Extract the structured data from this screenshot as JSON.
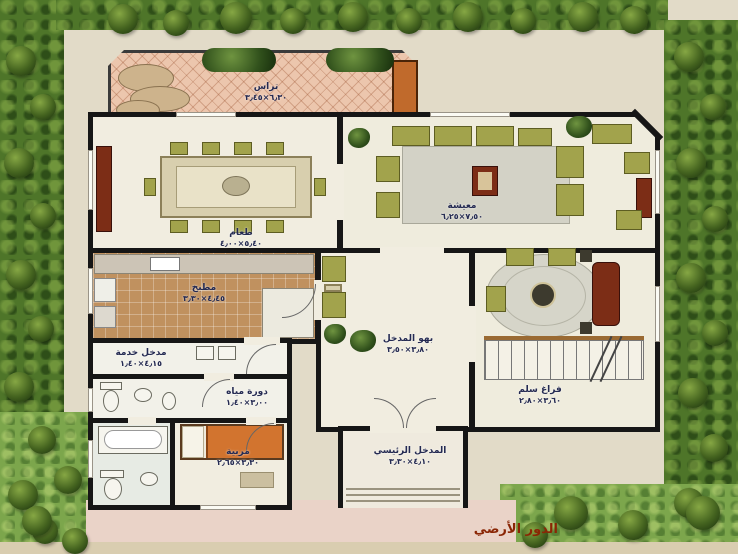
{
  "caption": "الدور الأرضي",
  "rooms": {
    "terrace": {
      "name": "تراس",
      "dims": "٦٫٣٠×٣٫٤٥"
    },
    "dining": {
      "name": "طعام",
      "dims": "٥٫٤٠×٤٫٠٠"
    },
    "living": {
      "name": "معيشة",
      "dims": "٧٫٥٠×٦٫٢٥"
    },
    "kitchen": {
      "name": "مطبخ",
      "dims": "٤٫٤٥×٣٫٣٠"
    },
    "hall": {
      "name": "بهو المدخل",
      "dims": "٣٫٨٠×٣٫٥٠"
    },
    "stairs": {
      "name": "فراغ سلم",
      "dims": "٣٫٦٠×٢٫٨٠"
    },
    "entrance": {
      "name": "المدخل الرئيسي",
      "dims": "٤٫١٠×٣٫٣٠"
    },
    "service": {
      "name": "مدخل خدمة",
      "dims": "٤٫١٥×١٫٤٠"
    },
    "toilet": {
      "name": "دورة مياه",
      "dims": "٣٫٠٠×١٫٤٠"
    },
    "maid": {
      "name": "مربية",
      "dims": "٣٫٣٠×٢٫٦٥"
    }
  },
  "colors": {
    "wall": "#161616",
    "hedge_green": "#4e7529",
    "grass_green": "#7ca64c",
    "pavement": "#e2dbc8",
    "terrace_tile": "#ecc6ad",
    "accent_orange": "#c06a2c",
    "furniture_olive": "#a2a34c",
    "furniture_maroon": "#7c2d16",
    "caption_red": "#8a2605",
    "label_navy": "#242a52"
  }
}
